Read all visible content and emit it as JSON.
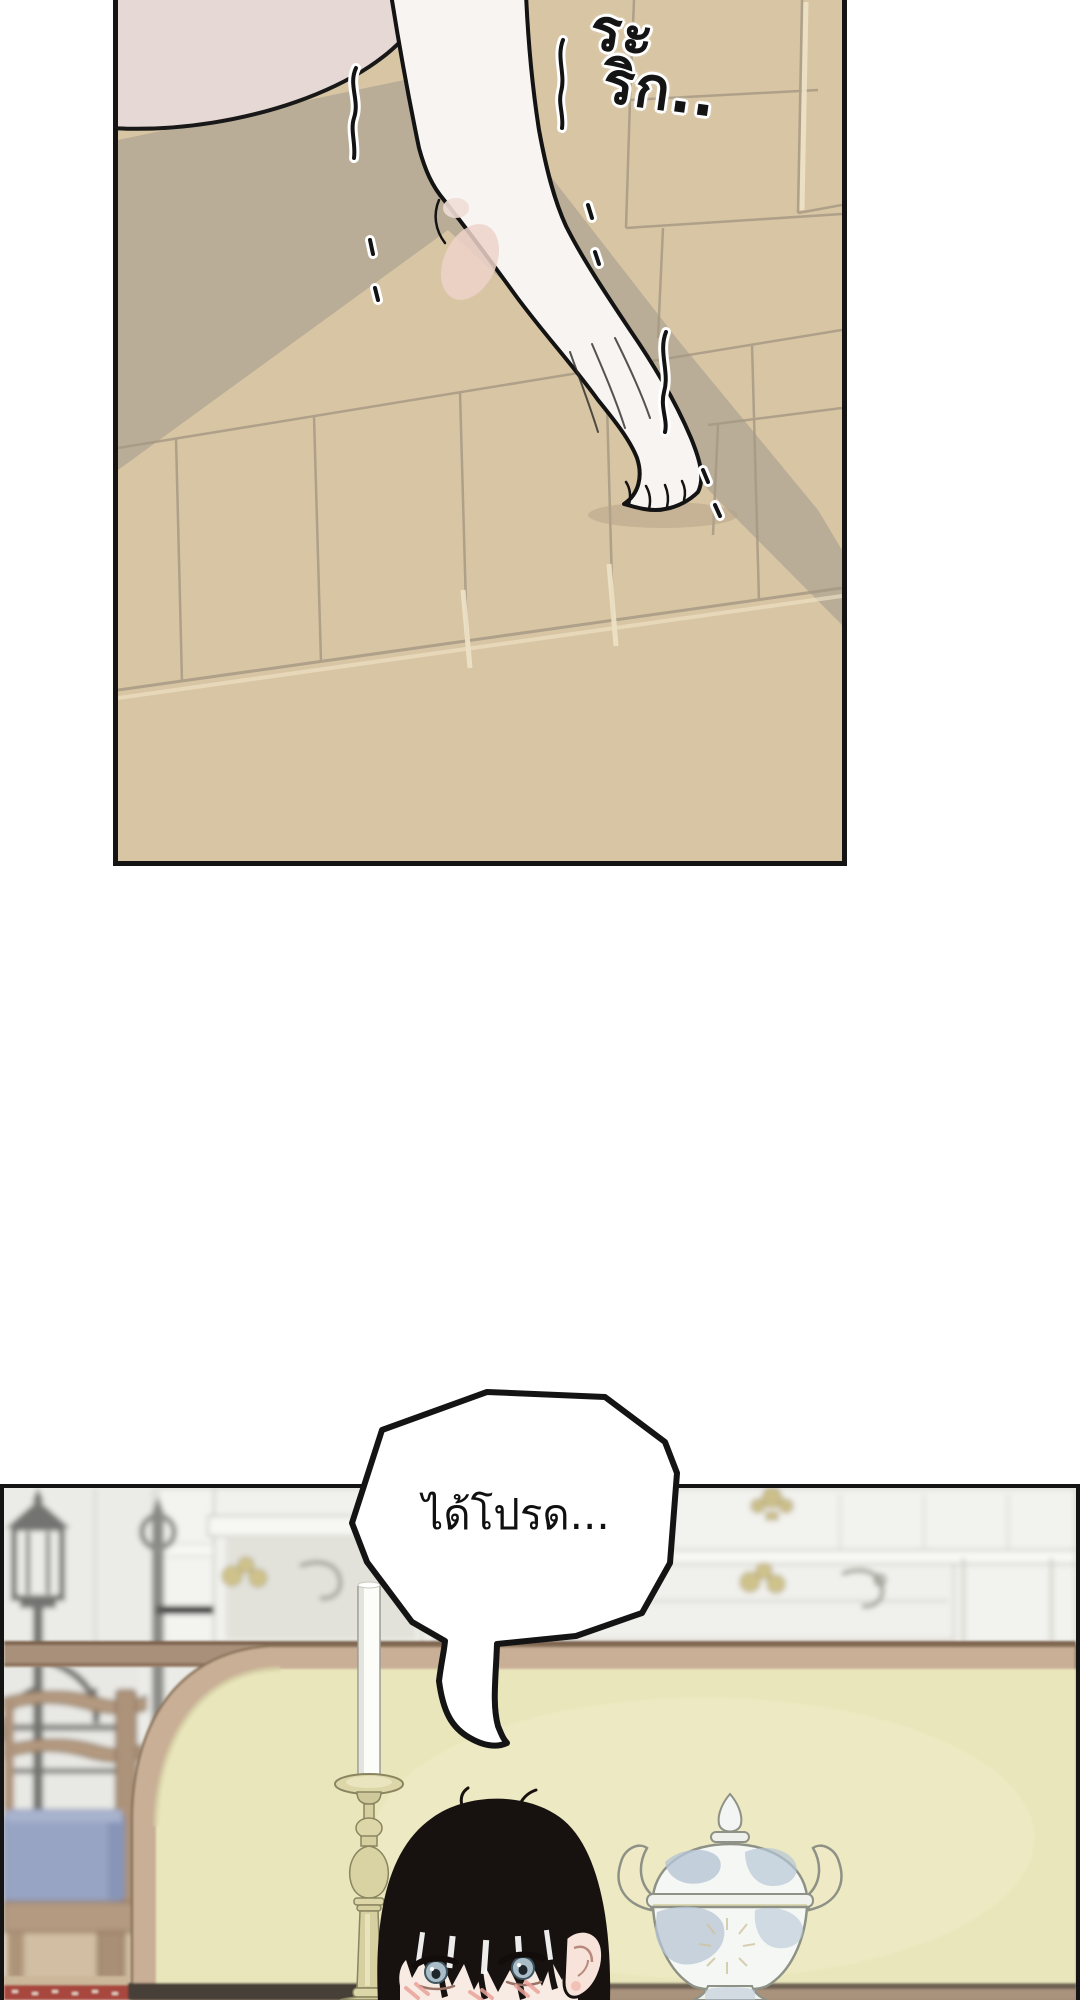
{
  "page": {
    "background": "#ffffff"
  },
  "panel_foot": {
    "sfx": {
      "text": "ระริก..",
      "line1": "ระ",
      "line2": "ริก.."
    },
    "colors": {
      "floor": "#d8c5a3",
      "floor_shadow": "#b6aa96",
      "skin": "#f8f4f1",
      "panel_border": "#141414"
    }
  },
  "panel_dining": {
    "speech_bubble": {
      "text": "ได้โปรด..."
    },
    "colors": {
      "wall": "#ebebe7",
      "bench_panel": "#eae6bc",
      "bench_frame": "#c9af96",
      "chair_cushion": "#97a4c3",
      "hair": "#17120f",
      "carpet": "#a8473e",
      "candlestick": "#d9d2a2",
      "tureen_pattern": "#b7c6d6",
      "table_rail": "#a9907a"
    }
  }
}
